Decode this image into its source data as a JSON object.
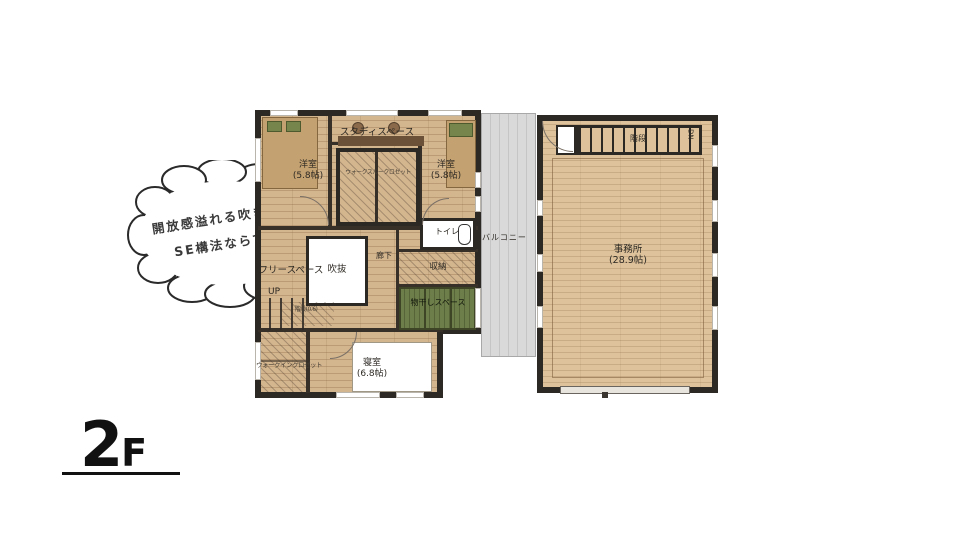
{
  "callout": {
    "line1": "開放感溢れる吹き抜けは",
    "line2": "SE構法ならでは。"
  },
  "floor_mark": {
    "big": "2",
    "small": "F"
  },
  "rooms": {
    "study": "スタディスペース",
    "bedroom_left": "洋室",
    "bedroom_left_size": "(5.8帖)",
    "bedroom_right": "洋室",
    "bedroom_right_size": "(5.8帖)",
    "walkthrough_closet": "ウォークスルークロゼット",
    "toilet": "トイレ",
    "balcony": "バルコニー",
    "office": "事務所",
    "office_size": "(28.9帖)",
    "stairs": "階段",
    "dn": "DN",
    "up": "UP",
    "stair_landing_note": "階段(0.6)",
    "void": "吹抜",
    "hallway": "廊下",
    "storage": "収納",
    "free_space": "フリースペース",
    "drying_space": "物干しスペース",
    "walkin_closet": "ウォークインクロゼット",
    "master_bedroom": "寝室",
    "master_bedroom_size": "(6.8帖)"
  },
  "colors": {
    "wall": "#2c2823",
    "wood": "#d3b58e",
    "wood_light": "#ddc29b",
    "balcony_gray": "#d9d9d9",
    "tatami_green": "#6e7e4a",
    "bed_tan": "#c4a170"
  }
}
